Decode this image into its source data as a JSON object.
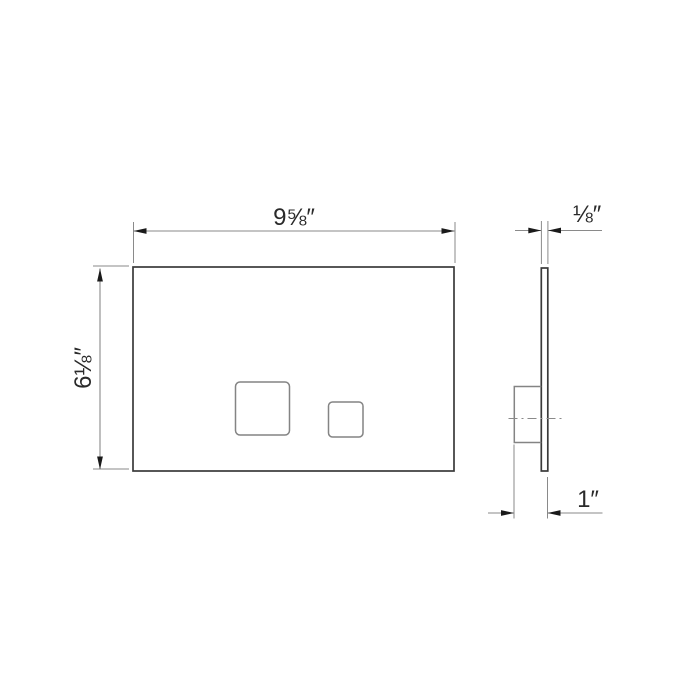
{
  "drawing": {
    "dimensions": {
      "front_width": "9⅝″",
      "front_height": "6⅛″",
      "plate_thickness": "⅛″",
      "mount_depth": "1″"
    },
    "colors": {
      "background": "#ffffff",
      "outline": "#3a3a3a",
      "detail": "#848484",
      "dimension_line": "#8a8a8a",
      "arrow": "#1a1a1a",
      "text": "#2a2a2a"
    }
  }
}
